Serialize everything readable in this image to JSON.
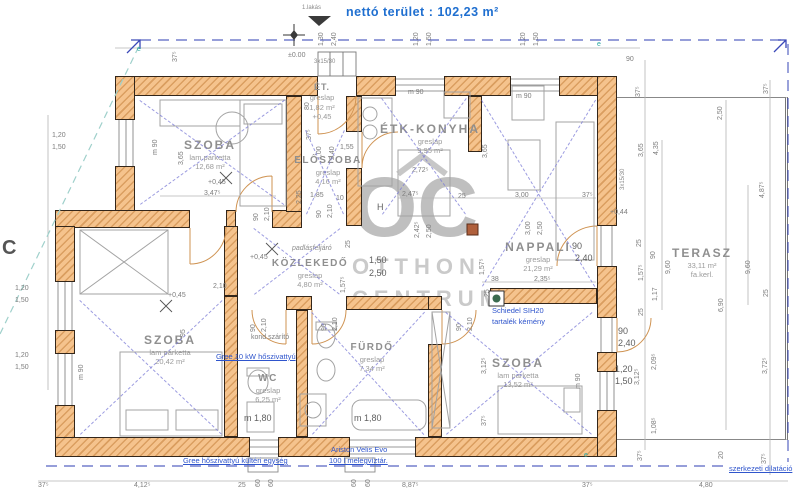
{
  "header": {
    "unit": "1.lakás",
    "net_area": "nettó terület : 102,23 m²"
  },
  "watermark": {
    "logo": "OC",
    "line1": "OTTHON",
    "line2": "CENTRUM"
  },
  "colors": {
    "wall_fill": "#f5c38d",
    "wall_hatch": "#ba7028",
    "wall_outline": "#33261a",
    "dim_text": "#7d7d7d",
    "blue_note": "#2f55cc",
    "blue_title": "#1f6fd0",
    "teal_mark": "#2aa7a0",
    "room_text": "#8f8f8f",
    "watermark": "#b3b3b3"
  },
  "rooms": [
    {
      "id": "szoba-1",
      "cx": 210,
      "cy": 138,
      "bounds": {
        "x": 140,
        "y": 100,
        "w": 144,
        "h": 104
      },
      "lines": [
        {
          "t": "SZOBA",
          "c": "room"
        },
        {
          "t": "lam.parketta",
          "c": "sub"
        },
        {
          "t": "12,68 m²",
          "c": "sub"
        }
      ]
    },
    {
      "id": "et",
      "cx": 322,
      "cy": 82,
      "lines": [
        {
          "t": "ÉT.",
          "c": "roomS"
        },
        {
          "t": "greslap",
          "c": "sub"
        },
        {
          "t": "1,82 m²",
          "c": "sub"
        },
        {
          "t": "+0,45",
          "c": "sub"
        }
      ]
    },
    {
      "id": "eloszoba",
      "cx": 328,
      "cy": 155,
      "bounds": {
        "x": 306,
        "y": 130,
        "w": 38,
        "h": 84
      },
      "lines": [
        {
          "t": "ELŐSZOBA",
          "c": "roomM"
        },
        {
          "t": "greslap",
          "c": "sub"
        },
        {
          "t": "4,16 m²",
          "c": "sub"
        }
      ]
    },
    {
      "id": "etk-konyha",
      "cx": 430,
      "cy": 122,
      "bounds": {
        "x": 382,
        "y": 98,
        "w": 84,
        "h": 116
      },
      "lines": [
        {
          "t": "ÉTK-KONYHA",
          "c": "room"
        },
        {
          "t": "greslap",
          "c": "sub"
        },
        {
          "t": "9,95 m²",
          "c": "sub"
        }
      ]
    },
    {
      "id": "nappali",
      "cx": 538,
      "cy": 240,
      "bounds": {
        "x": 482,
        "y": 100,
        "w": 113,
        "h": 186
      },
      "lines": [
        {
          "t": "NAPPALI",
          "c": "room"
        },
        {
          "t": "greslap",
          "c": "sub"
        },
        {
          "t": "21,29 m²",
          "c": "sub"
        }
      ]
    },
    {
      "id": "kozlekedo",
      "cx": 310,
      "cy": 258,
      "bounds": {
        "x": 254,
        "y": 228,
        "w": 86,
        "h": 66
      },
      "lines": [
        {
          "t": "KÖZLEKEDŐ",
          "c": "roomM"
        },
        {
          "t": "greslap",
          "c": "sub"
        },
        {
          "t": "4,80 m²",
          "c": "sub"
        }
      ]
    },
    {
      "id": "szoba-2",
      "cx": 170,
      "cy": 333,
      "bounds": {
        "x": 80,
        "y": 300,
        "w": 142,
        "h": 134
      },
      "lines": [
        {
          "t": "SZOBA",
          "c": "room"
        },
        {
          "t": "lam parketta",
          "c": "sub"
        },
        {
          "t": "20,42 m²",
          "c": "sub"
        }
      ]
    },
    {
      "id": "wc",
      "cx": 268,
      "cy": 373,
      "lines": [
        {
          "t": "WC",
          "c": "roomM"
        },
        {
          "t": "greslap",
          "c": "sub"
        },
        {
          "t": "6,25 m²",
          "c": "sub"
        }
      ]
    },
    {
      "id": "furdo",
      "cx": 372,
      "cy": 342,
      "bounds": {
        "x": 312,
        "y": 312,
        "w": 112,
        "h": 122
      },
      "lines": [
        {
          "t": "FÜRDŐ",
          "c": "roomM"
        },
        {
          "t": "greslap",
          "c": "sub"
        },
        {
          "t": "7,34 m²",
          "c": "sub"
        }
      ]
    },
    {
      "id": "szoba-3",
      "cx": 518,
      "cy": 356,
      "bounds": {
        "x": 446,
        "y": 312,
        "w": 146,
        "h": 122
      },
      "lines": [
        {
          "t": "SZOBA",
          "c": "room"
        },
        {
          "t": "lam parketta",
          "c": "sub"
        },
        {
          "t": "13,52 m²",
          "c": "sub"
        }
      ]
    },
    {
      "id": "terasz",
      "cx": 702,
      "cy": 246,
      "lines": [
        {
          "t": "TERASZ",
          "c": "room"
        },
        {
          "t": "33,11 m²",
          "c": "sub"
        },
        {
          "t": "fa.kerl.",
          "c": "sub"
        }
      ]
    }
  ],
  "annotations": [
    {
      "t": "Gree 10 kW hőszivattyú",
      "x": 216,
      "y": 353,
      "u": 1
    },
    {
      "t": "Schiedel SIH20",
      "x": 492,
      "y": 307
    },
    {
      "t": "tartalék kémény",
      "x": 492,
      "y": 318
    },
    {
      "t": "Gree hőszivattyú kültéri egység",
      "x": 183,
      "y": 457,
      "u": 1
    },
    {
      "t": "Ariston Velis Evo",
      "x": 331,
      "y": 446
    },
    {
      "t": "100 l melegvíztár.",
      "x": 329,
      "y": 457,
      "u": 1
    },
    {
      "t": "szerkezeti dilatáció",
      "x": 729,
      "y": 465,
      "u": 1
    }
  ],
  "dims": [
    {
      "t": "±0.00",
      "x": 288,
      "y": 52
    },
    {
      "t": "3x15/30",
      "x": 314,
      "y": 59,
      "c": "tiny"
    },
    {
      "t": "1,30",
      "x": 318,
      "y": 46,
      "r": 1
    },
    {
      "t": "2,40",
      "x": 331,
      "y": 46,
      "r": 1
    },
    {
      "t": "1,20",
      "x": 413,
      "y": 46,
      "r": 1
    },
    {
      "t": "1,50",
      "x": 426,
      "y": 46,
      "r": 1
    },
    {
      "t": "1,20",
      "x": 520,
      "y": 46,
      "r": 1
    },
    {
      "t": "1,50",
      "x": 533,
      "y": 46,
      "r": 1
    },
    {
      "t": "37⁵",
      "x": 172,
      "y": 62,
      "r": 1
    },
    {
      "t": "90",
      "x": 626,
      "y": 56
    },
    {
      "t": "e",
      "x": 137,
      "y": 46,
      "c": "teal"
    },
    {
      "t": "e",
      "x": 597,
      "y": 41,
      "c": "teal"
    },
    {
      "t": "e",
      "x": 584,
      "y": 452,
      "c": "teal"
    },
    {
      "t": "C",
      "x": 2,
      "y": 238,
      "c": "big"
    },
    {
      "t": "1,20",
      "x": 52,
      "y": 132
    },
    {
      "t": "1,50",
      "x": 52,
      "y": 144
    },
    {
      "t": "m 90",
      "x": 152,
      "y": 155,
      "r": 1
    },
    {
      "t": "3,65",
      "x": 178,
      "y": 165,
      "r": 1
    },
    {
      "t": "1,20",
      "x": 15,
      "y": 285
    },
    {
      "t": "1,50",
      "x": 15,
      "y": 297
    },
    {
      "t": "1,20",
      "x": 15,
      "y": 352
    },
    {
      "t": "1,50",
      "x": 15,
      "y": 364
    },
    {
      "t": "m 90",
      "x": 78,
      "y": 380,
      "r": 1
    },
    {
      "t": "+0,45",
      "x": 208,
      "y": 179
    },
    {
      "t": "3,47⁵",
      "x": 204,
      "y": 190
    },
    {
      "t": "80",
      "x": 304,
      "y": 110,
      "r": 1
    },
    {
      "t": "37⁵",
      "x": 306,
      "y": 140,
      "r": 1
    },
    {
      "t": "1,00",
      "x": 316,
      "y": 160,
      "r": 1
    },
    {
      "t": "2,40",
      "x": 329,
      "y": 160,
      "r": 1
    },
    {
      "t": "1,55",
      "x": 340,
      "y": 144
    },
    {
      "t": "2,25",
      "x": 296,
      "y": 204,
      "r": 1
    },
    {
      "t": "1,85",
      "x": 310,
      "y": 192
    },
    {
      "t": "10",
      "x": 336,
      "y": 195
    },
    {
      "t": "90",
      "x": 316,
      "y": 218,
      "r": 1
    },
    {
      "t": "2,10",
      "x": 327,
      "y": 218,
      "r": 1
    },
    {
      "t": "90",
      "x": 253,
      "y": 221,
      "r": 1
    },
    {
      "t": "2,10",
      "x": 264,
      "y": 221,
      "r": 1
    },
    {
      "t": "m 90",
      "x": 408,
      "y": 89
    },
    {
      "t": "2,72⁵",
      "x": 412,
      "y": 167
    },
    {
      "t": "2,47⁵",
      "x": 402,
      "y": 191
    },
    {
      "t": "25",
      "x": 458,
      "y": 193
    },
    {
      "t": "H",
      "x": 377,
      "y": 203,
      "c": "dimb"
    },
    {
      "t": "2,42⁵",
      "x": 414,
      "y": 238,
      "r": 1
    },
    {
      "t": "2,50",
      "x": 426,
      "y": 238,
      "r": 1
    },
    {
      "t": "3,00",
      "x": 515,
      "y": 192
    },
    {
      "t": "37⁵",
      "x": 582,
      "y": 192
    },
    {
      "t": "3,65",
      "x": 482,
      "y": 158,
      "r": 1
    },
    {
      "t": "m 90",
      "x": 516,
      "y": 93
    },
    {
      "t": "3,00",
      "x": 525,
      "y": 235,
      "r": 1
    },
    {
      "t": "2,50",
      "x": 537,
      "y": 235,
      "r": 1
    },
    {
      "t": "90",
      "x": 572,
      "y": 242,
      "c": "dimb"
    },
    {
      "t": "2,40",
      "x": 575,
      "y": 254,
      "c": "dimb"
    },
    {
      "t": "+0,44",
      "x": 610,
      "y": 209
    },
    {
      "t": "1,57⁵",
      "x": 479,
      "y": 275,
      "r": 1
    },
    {
      "t": "38",
      "x": 491,
      "y": 276
    },
    {
      "t": "2,35⁵",
      "x": 534,
      "y": 276
    },
    {
      "t": "25",
      "x": 484,
      "y": 297,
      "r": 1
    },
    {
      "t": "90",
      "x": 618,
      "y": 327,
      "c": "dimb"
    },
    {
      "t": "2,40",
      "x": 618,
      "y": 339,
      "c": "dimb"
    },
    {
      "t": "25",
      "x": 636,
      "y": 247,
      "r": 1
    },
    {
      "t": "90",
      "x": 650,
      "y": 259,
      "r": 1
    },
    {
      "t": "1,57⁵",
      "x": 638,
      "y": 281,
      "r": 1
    },
    {
      "t": "1,17",
      "x": 652,
      "y": 301,
      "r": 1
    },
    {
      "t": "25",
      "x": 638,
      "y": 316,
      "r": 1
    },
    {
      "t": "padlásfeljáró",
      "x": 292,
      "y": 245,
      "c": "ital"
    },
    {
      "t": "+0,45",
      "x": 250,
      "y": 254
    },
    {
      "t": "1,50",
      "x": 369,
      "y": 256,
      "c": "dimb"
    },
    {
      "t": "2,50",
      "x": 369,
      "y": 269,
      "c": "dimb"
    },
    {
      "t": "25",
      "x": 345,
      "y": 248,
      "r": 1
    },
    {
      "t": "1,57⁵",
      "x": 340,
      "y": 293,
      "r": 1
    },
    {
      "t": "2,10",
      "x": 213,
      "y": 283
    },
    {
      "t": "95",
      "x": 180,
      "y": 337,
      "r": 1
    },
    {
      "t": "90",
      "x": 250,
      "y": 332,
      "r": 1
    },
    {
      "t": "2,10",
      "x": 261,
      "y": 332,
      "r": 1
    },
    {
      "t": "90",
      "x": 321,
      "y": 331,
      "r": 1
    },
    {
      "t": "2,10",
      "x": 332,
      "y": 331,
      "r": 1
    },
    {
      "t": "90",
      "x": 456,
      "y": 331,
      "r": 1
    },
    {
      "t": "2,10",
      "x": 467,
      "y": 331,
      "r": 1
    },
    {
      "t": "kond.szárító",
      "x": 251,
      "y": 334
    },
    {
      "t": "m 1,80",
      "x": 244,
      "y": 414,
      "c": "dimb"
    },
    {
      "t": "m 1,80",
      "x": 354,
      "y": 414,
      "c": "dimb"
    },
    {
      "t": "+0,45",
      "x": 168,
      "y": 292
    },
    {
      "t": "3,12⁵",
      "x": 481,
      "y": 374,
      "r": 1
    },
    {
      "t": "37⁵",
      "x": 481,
      "y": 426,
      "r": 1
    },
    {
      "t": "m 90",
      "x": 575,
      "y": 389,
      "r": 1
    },
    {
      "t": "1,20",
      "x": 615,
      "y": 365,
      "c": "dimb"
    },
    {
      "t": "1,50",
      "x": 615,
      "y": 377,
      "c": "dimb"
    },
    {
      "t": "37⁵",
      "x": 635,
      "y": 97,
      "r": 1
    },
    {
      "t": "3,65",
      "x": 638,
      "y": 157,
      "r": 1
    },
    {
      "t": "4,35",
      "x": 653,
      "y": 155,
      "r": 1
    },
    {
      "t": "3x15/30",
      "x": 620,
      "y": 190,
      "r": 1,
      "c": "tiny"
    },
    {
      "t": "2,50",
      "x": 717,
      "y": 120,
      "r": 1
    },
    {
      "t": "37⁵",
      "x": 763,
      "y": 94,
      "r": 1
    },
    {
      "t": "4,87⁵",
      "x": 759,
      "y": 198,
      "r": 1
    },
    {
      "t": "9,60",
      "x": 665,
      "y": 274,
      "r": 1
    },
    {
      "t": "9,60",
      "x": 745,
      "y": 274,
      "r": 1
    },
    {
      "t": "6,90",
      "x": 718,
      "y": 312,
      "r": 1
    },
    {
      "t": "25",
      "x": 763,
      "y": 297,
      "r": 1
    },
    {
      "t": "2,09⁵",
      "x": 651,
      "y": 370,
      "r": 1
    },
    {
      "t": "3,12⁵",
      "x": 634,
      "y": 385,
      "r": 1
    },
    {
      "t": "1,08⁵",
      "x": 651,
      "y": 434,
      "r": 1
    },
    {
      "t": "3,72⁵",
      "x": 762,
      "y": 374,
      "r": 1
    },
    {
      "t": "37⁵",
      "x": 637,
      "y": 461,
      "r": 1
    },
    {
      "t": "20",
      "x": 718,
      "y": 459,
      "r": 1
    },
    {
      "t": "37⁵",
      "x": 761,
      "y": 464,
      "r": 1
    },
    {
      "t": "37⁵",
      "x": 38,
      "y": 482
    },
    {
      "t": "4,12⁵",
      "x": 134,
      "y": 482
    },
    {
      "t": "25",
      "x": 238,
      "y": 482
    },
    {
      "t": "8,87⁵",
      "x": 402,
      "y": 482
    },
    {
      "t": "37⁵",
      "x": 582,
      "y": 482
    },
    {
      "t": "4,80",
      "x": 699,
      "y": 482
    },
    {
      "t": "60",
      "x": 255,
      "y": 487,
      "r": 1
    },
    {
      "t": "60",
      "x": 268,
      "y": 487,
      "r": 1
    },
    {
      "t": "60",
      "x": 351,
      "y": 487,
      "r": 1
    },
    {
      "t": "60",
      "x": 365,
      "y": 487,
      "r": 1
    }
  ]
}
